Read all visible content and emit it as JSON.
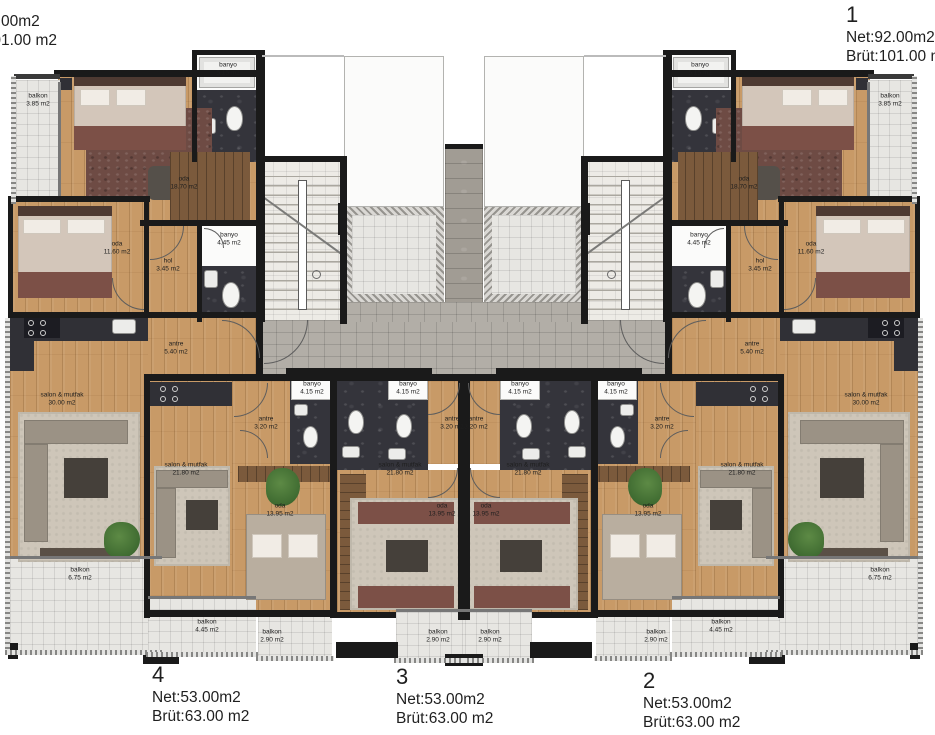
{
  "corner_labels": {
    "top_left": {
      "net": "Net:92.00m2",
      "brut": "Brüt:101.00 m2"
    },
    "unit_1": {
      "number": "1",
      "net": "Net:92.00m2",
      "brut": "Brüt:101.00 m2"
    },
    "unit_4": {
      "number": "4",
      "net": "Net:53.00m2",
      "brut": "Brüt:63.00 m2"
    },
    "unit_3": {
      "number": "3",
      "net": "Net:53.00m2",
      "brut": "Brüt:63.00 m2"
    },
    "unit_2": {
      "number": "2",
      "net": "Net:53.00m2",
      "brut": "Brüt:63.00 m2"
    }
  },
  "room_labels": [
    {
      "name": "balkon",
      "area": "3.85 m2",
      "x": 38,
      "y": 101
    },
    {
      "name": "banyo",
      "area": "5.15 m2",
      "x": 228,
      "y": 70
    },
    {
      "name": "oda",
      "area": "18.70 m2",
      "x": 184,
      "y": 184
    },
    {
      "name": "oda",
      "area": "11.60 m2",
      "x": 117,
      "y": 249
    },
    {
      "name": "hol",
      "area": "3.45 m2",
      "x": 168,
      "y": 266
    },
    {
      "name": "banyo",
      "area": "4.45 m2",
      "x": 229,
      "y": 240
    },
    {
      "name": "antre",
      "area": "5.40 m2",
      "x": 176,
      "y": 349
    },
    {
      "name": "salon & mutfak",
      "area": "30.00 m2",
      "x": 62,
      "y": 400
    },
    {
      "name": "balkon",
      "area": "6.75 m2",
      "x": 80,
      "y": 575
    },
    {
      "name": "balkon",
      "area": "3.85 m2",
      "x": 890,
      "y": 101
    },
    {
      "name": "banyo",
      "area": "5.15 m2",
      "x": 700,
      "y": 70
    },
    {
      "name": "oda",
      "area": "18.70 m2",
      "x": 744,
      "y": 184
    },
    {
      "name": "oda",
      "area": "11.60 m2",
      "x": 811,
      "y": 249
    },
    {
      "name": "hol",
      "area": "3.45 m2",
      "x": 760,
      "y": 266
    },
    {
      "name": "banyo",
      "area": "4.45 m2",
      "x": 699,
      "y": 240
    },
    {
      "name": "antre",
      "area": "5.40 m2",
      "x": 752,
      "y": 349
    },
    {
      "name": "salon & mutfak",
      "area": "30.00 m2",
      "x": 866,
      "y": 400
    },
    {
      "name": "balkon",
      "area": "6.75 m2",
      "x": 880,
      "y": 575
    },
    {
      "name": "banyo",
      "area": "4.15 m2",
      "x": 312,
      "y": 389
    },
    {
      "name": "antre",
      "area": "3.20 m2",
      "x": 266,
      "y": 424
    },
    {
      "name": "salon & mutfak",
      "area": "21.80 m2",
      "x": 186,
      "y": 470
    },
    {
      "name": "oda",
      "area": "13.95 m2",
      "x": 280,
      "y": 511
    },
    {
      "name": "banyo",
      "area": "4.15 m2",
      "x": 408,
      "y": 389
    },
    {
      "name": "antre",
      "area": "3.20 m2",
      "x": 452,
      "y": 424
    },
    {
      "name": "salon & mutfak",
      "area": "21.80 m2",
      "x": 400,
      "y": 470
    },
    {
      "name": "oda",
      "area": "13.95 m2",
      "x": 442,
      "y": 511
    },
    {
      "name": "banyo",
      "area": "4.15 m2",
      "x": 520,
      "y": 389
    },
    {
      "name": "antre",
      "area": "3.20 m2",
      "x": 476,
      "y": 424
    },
    {
      "name": "salon & mutfak",
      "area": "21.80 m2",
      "x": 528,
      "y": 470
    },
    {
      "name": "oda",
      "area": "13.95 m2",
      "x": 486,
      "y": 511
    },
    {
      "name": "banyo",
      "area": "4.15 m2",
      "x": 616,
      "y": 389
    },
    {
      "name": "antre",
      "area": "3.20 m2",
      "x": 662,
      "y": 424
    },
    {
      "name": "salon & mutfak",
      "area": "21.80 m2",
      "x": 742,
      "y": 470
    },
    {
      "name": "oda",
      "area": "13.95 m2",
      "x": 648,
      "y": 511
    },
    {
      "name": "balkon",
      "area": "4.45 m2",
      "x": 207,
      "y": 627
    },
    {
      "name": "balkon",
      "area": "2.90 m2",
      "x": 272,
      "y": 637
    },
    {
      "name": "balkon",
      "area": "2.90 m2",
      "x": 438,
      "y": 637
    },
    {
      "name": "balkon",
      "area": "2.90 m2",
      "x": 490,
      "y": 637
    },
    {
      "name": "balkon",
      "area": "2.90 m2",
      "x": 656,
      "y": 637
    },
    {
      "name": "balkon",
      "area": "4.45 m2",
      "x": 721,
      "y": 627
    }
  ],
  "colors": {
    "wood": "#c89a67",
    "tile": "#e7e6e2",
    "marble": "#34343b",
    "wall": "#1a1a1a",
    "stone": "#b2aea7",
    "wardrobe": "#7b5a3c",
    "rug": "#cec6b9",
    "accent_red": "#7c5047",
    "plant": "#3f6b31",
    "text": "#1f1f1f"
  }
}
